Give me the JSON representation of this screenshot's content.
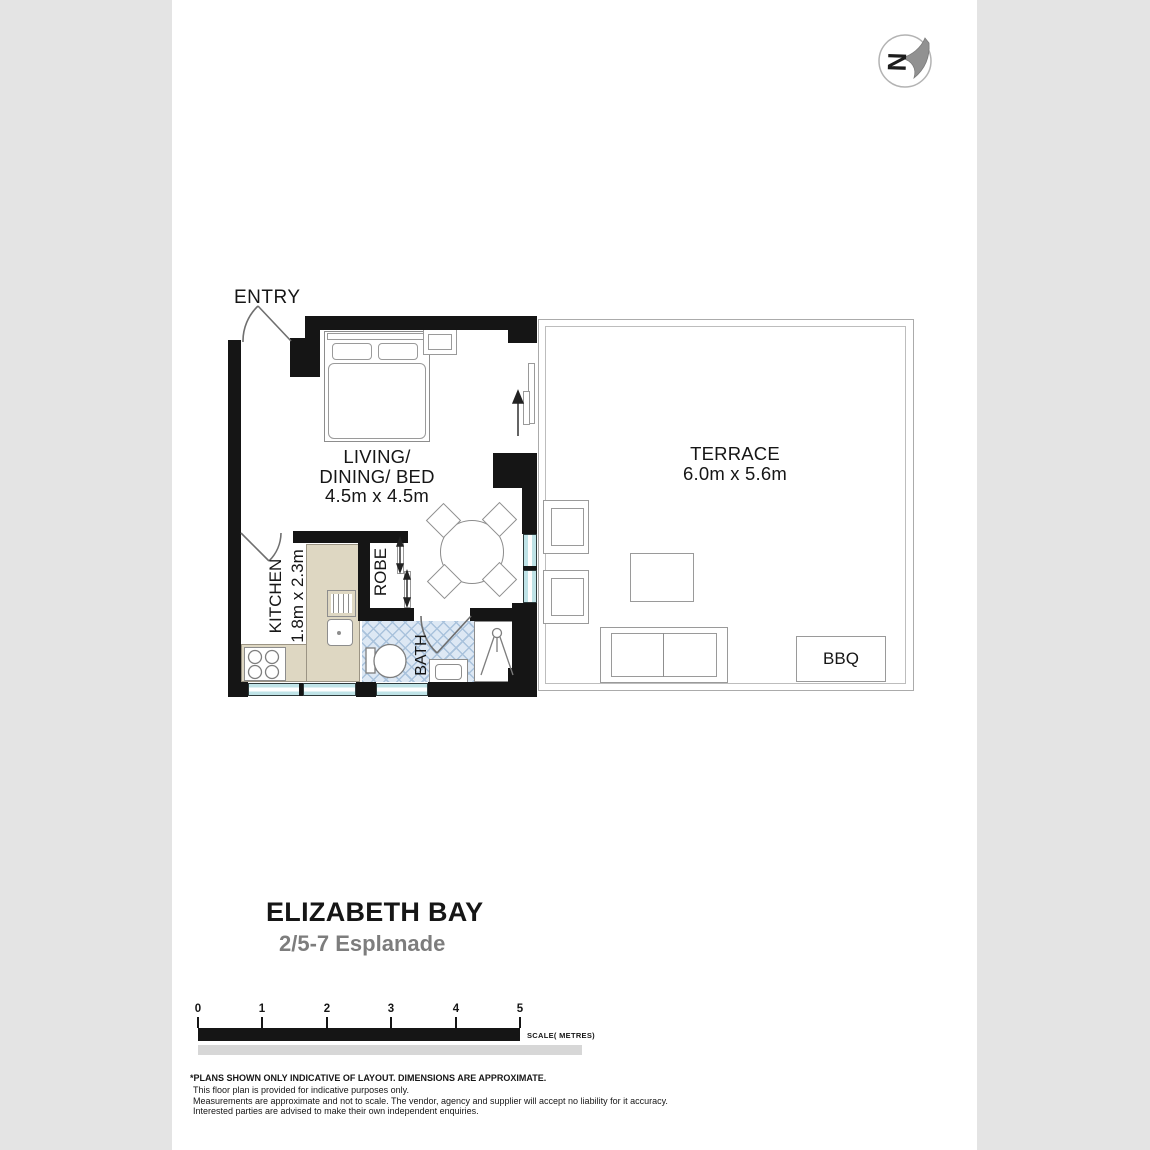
{
  "header": {
    "compass_glyph": "N"
  },
  "rooms": {
    "entry": {
      "label": "ENTRY"
    },
    "living": {
      "line1": "LIVING/",
      "line2": "DINING/ BED",
      "dims": "4.5m x 4.5m"
    },
    "kitchen": {
      "label": "KITCHEN",
      "dims": "1.8m x 2.3m"
    },
    "robe": {
      "label": "ROBE"
    },
    "bath": {
      "label": "BATH"
    },
    "terrace": {
      "label": "TERRACE",
      "dims": "6.0m x 5.6m"
    },
    "bbq": {
      "label": "BBQ"
    }
  },
  "title": {
    "suburb": "ELIZABETH BAY",
    "address": "2/5-7 Esplanade"
  },
  "scale_bar": {
    "ticks": [
      "0",
      "1",
      "2",
      "3",
      "4",
      "5"
    ],
    "caption": "SCALE( METRES)"
  },
  "disclaimer": {
    "headline": "*PLANS SHOWN ONLY INDICATIVE OF LAYOUT. DIMENSIONS ARE APPROXIMATE.",
    "line1": "This floor plan is provided for indicative purposes only.",
    "line2": "Measurements are approximate and not to scale. The vendor, agency and supplier will accept no liability for it accuracy.",
    "line3": "Interested parties are advised to make their own independent enquiries."
  },
  "colors": {
    "wall": "#151515",
    "window_glass": "#bfe3e7",
    "counter": "#ded7c2",
    "tile_bg": "#dde8f4",
    "subtitle_gray": "#7d7d7d"
  }
}
